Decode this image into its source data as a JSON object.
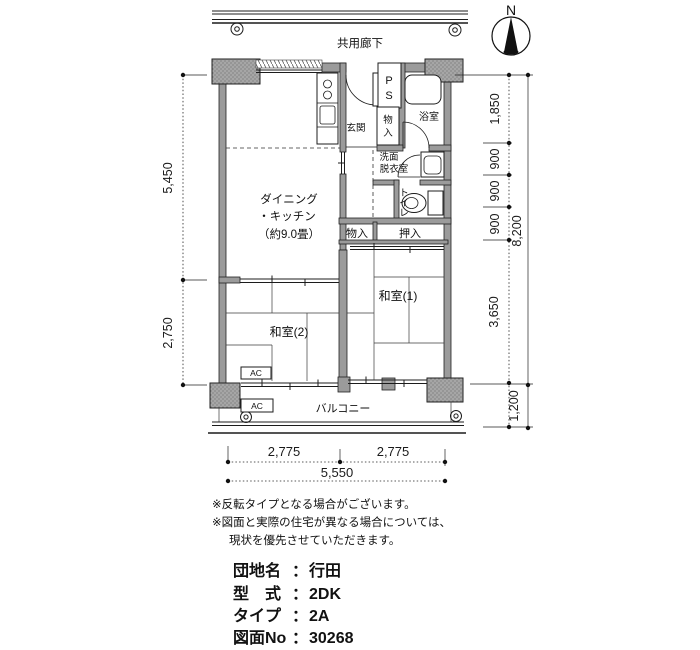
{
  "compass": {
    "north": "N"
  },
  "corridor": {
    "label": "共用廊下"
  },
  "plan": {
    "dk": {
      "l1": "ダイニング",
      "l2": "・キッチン",
      "l3": "（約9.0畳）"
    },
    "genkan": "玄関",
    "ps": {
      "p": "P",
      "s": "S"
    },
    "mono_genkan": {
      "c1": "物",
      "c2": "入"
    },
    "bath": "浴室",
    "senmen": {
      "l1": "洗面",
      "l2": "脱衣室"
    },
    "toilet": {
      "c1": "ト",
      "c2": "イ",
      "c3": "レ"
    },
    "mono_center": "物入",
    "oshiire": "押入",
    "washitsu1": "和室(1)",
    "washitsu2": "和室(2)",
    "balcony": "バルコニー",
    "ac_room": "AC",
    "ac_balcony": "AC"
  },
  "dims": {
    "left_upper": "5,450",
    "left_lower": "2,750",
    "right": {
      "d1": "1,850",
      "d2": "900",
      "d3": "900",
      "d4": "900",
      "d5": "3,650",
      "d6": "1,200",
      "total": "8,200"
    },
    "bottom": {
      "left": "2,775",
      "right": "2,775",
      "total": "5,550"
    }
  },
  "notes": {
    "l1": "※反転タイプとなる場合がございます。",
    "l2": "※図面と実際の住宅が異なる場合については、",
    "l3": "現状を優先させていただきます。"
  },
  "info": {
    "sep": "：",
    "rows": [
      {
        "label": "団地名",
        "value": "行田"
      },
      {
        "label": "型　式",
        "value": "2DK"
      },
      {
        "label": "タイプ",
        "value": "2A"
      },
      {
        "label": "図面No",
        "value": "30268"
      }
    ]
  }
}
